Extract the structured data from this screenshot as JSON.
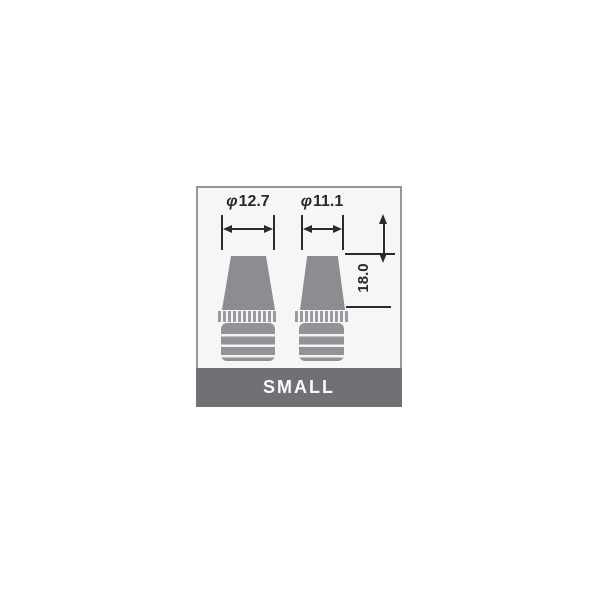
{
  "diagram_card": {
    "size_label": "SMALL",
    "annotations": {
      "left_diameter": {
        "symbol": "φ",
        "value": "12.7"
      },
      "right_diameter": {
        "symbol": "φ",
        "value": "11.1"
      },
      "height_value": "18.0"
    },
    "colors": {
      "banner_bg": "#717175",
      "banner_text": "#fafafa",
      "diagram_bg": "#f6f6f7",
      "diagram_border": "#97979b",
      "part_fill": "#8d8d91",
      "dimension_line": "#2b2b2d"
    }
  }
}
